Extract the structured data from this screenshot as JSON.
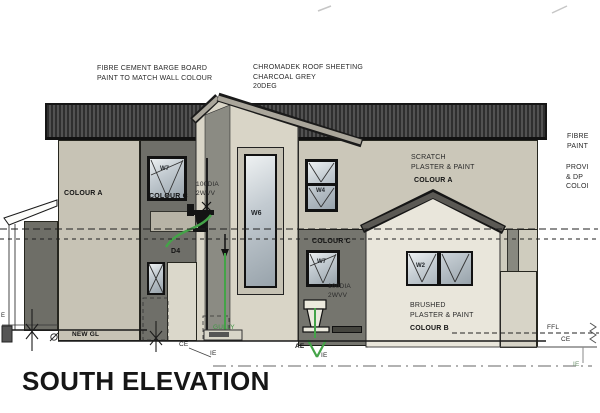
{
  "title": "SOUTH ELEVATION",
  "notes": {
    "barge_board": "FIBRE CEMENT BARGE BOARD\nPAINT TO MATCH WALL COLOUR",
    "roof_sheeting": "CHROMADEK ROOF SHEETING\nCHARCOAL GREY\n20DEG",
    "scratch_plaster": "SCRATCH\nPLASTER & PAINT",
    "scratch_colour": "COLOUR A",
    "brushed_plaster": "BRUSHED\nPLASTER & PAINT",
    "brushed_colour": "COLOUR B",
    "edge_note_1": "FIBRE\nPAINT",
    "edge_note_2": "PROVI\n& DP\nCOLOI",
    "vent_left": "100DIA\n2WVV",
    "vent_right": "100DIA\n2WVV"
  },
  "walls": {
    "colour_a": "COLOUR A",
    "colour_c_left": "COLOUR C",
    "colour_c_right": "COLOUR C"
  },
  "openings": {
    "w7_left": "W7",
    "w6": "W6",
    "w4": "W4",
    "w7_right": "W7",
    "w2": "W2",
    "d4": "D4"
  },
  "levels": {
    "new_gl": "NEW GL",
    "ffl": "FFL",
    "ce_left": "CE",
    "ce_right": "CE",
    "ie_left": "IE",
    "ie_mid": "IE",
    "ie_right": "IE",
    "ae": "AE",
    "gully": "GULLY",
    "edge_mark": "E"
  },
  "colors": {
    "roof_charcoal": "#3a3a3a",
    "wall_light": "#c7c3b5",
    "wall_dark": "#6f6f69",
    "tower_face": "#d9d5c7",
    "tower_side": "#8b8b83",
    "gable_wall": "#e9e6db",
    "pipe_green": "#44a348",
    "glazing": "#b9c2c8"
  }
}
